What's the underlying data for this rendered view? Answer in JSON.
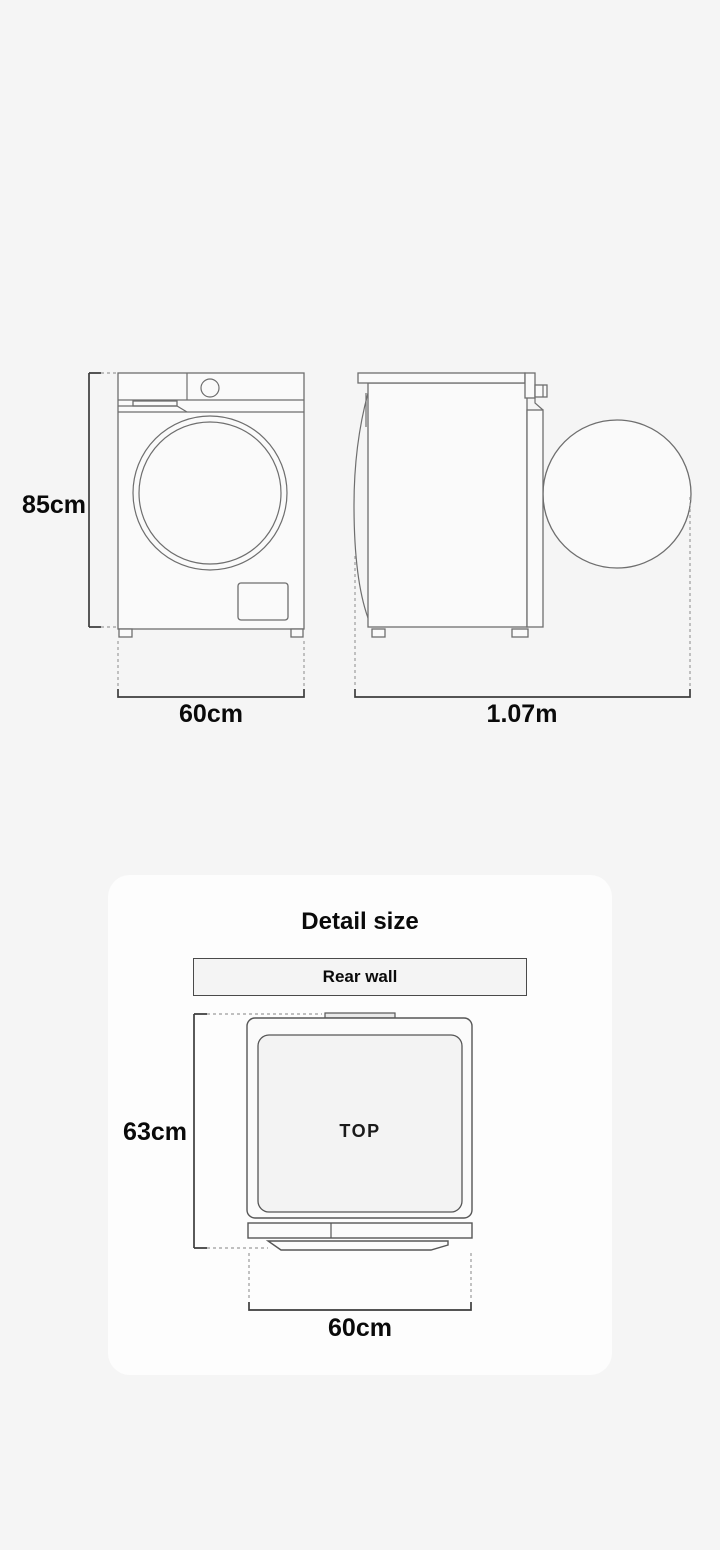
{
  "page": {
    "background_color": "#f5f5f5",
    "outline_color": "#6e6e6e",
    "dimension_line_color": "#3d3d3d",
    "dashed_line_color": "#9c9c9c",
    "text_color": "#0a0a0a"
  },
  "front_view": {
    "height_label": "85cm",
    "width_label": "60cm"
  },
  "side_view": {
    "depth_label": "1.07m"
  },
  "detail_card": {
    "title": "Detail size",
    "card_background": "#fdfdfd",
    "rear_wall_label": "Rear wall",
    "top_face_label": "TOP",
    "depth_label": "63cm",
    "width_label": "60cm"
  }
}
